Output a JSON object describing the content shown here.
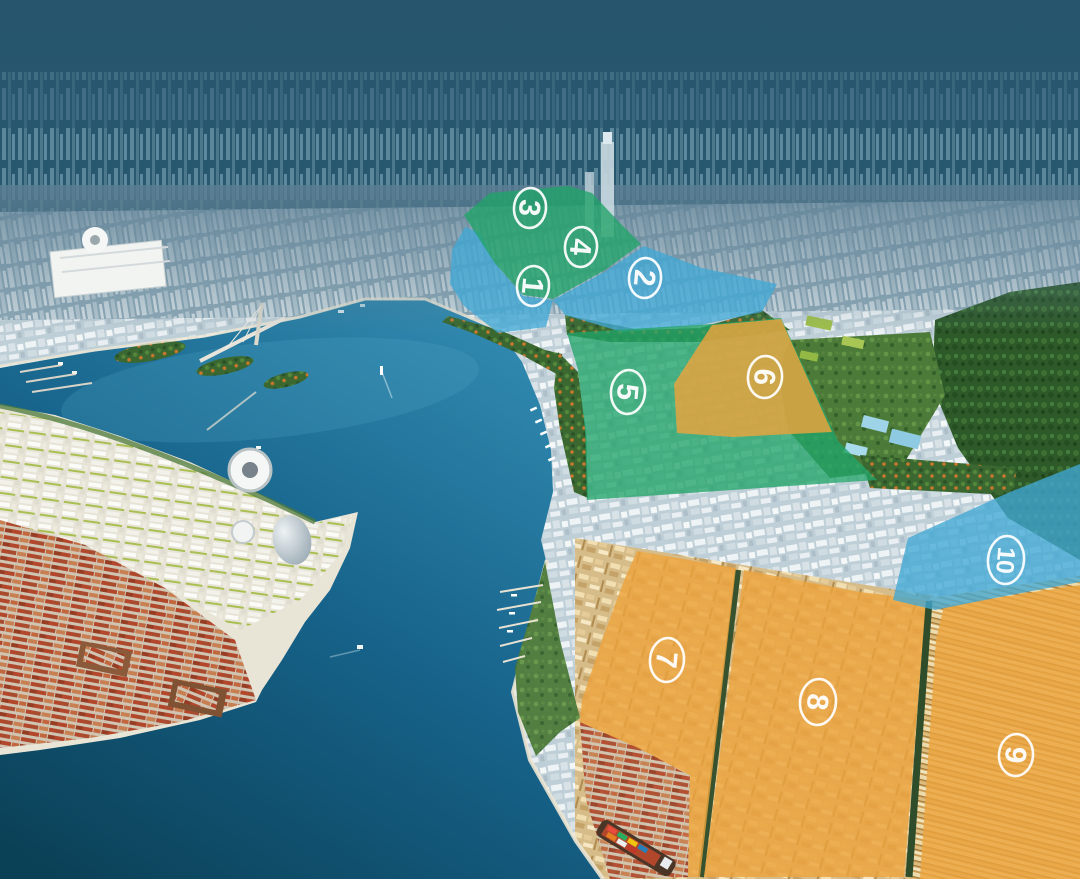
{
  "map": {
    "description": "Aerial masterplan rendering of a coastal bay city with ten numbered planning zones overlaid in color",
    "colors": {
      "sky": "#27566e",
      "haze_city": "#6e96a9",
      "water_light": "#2f87ad",
      "water_deep": "#0b4157",
      "zone_green": "#21a469",
      "zone_blue": "#41a8d5",
      "zone_orange": "#eca33d",
      "badge": "#ffffff",
      "container_red": "#b2472c",
      "forest": "#2e5a2a"
    },
    "zones": [
      {
        "label": "1",
        "color": "blue"
      },
      {
        "label": "2",
        "color": "blue"
      },
      {
        "label": "3",
        "color": "green"
      },
      {
        "label": "4",
        "color": "green"
      },
      {
        "label": "5",
        "color": "green"
      },
      {
        "label": "6",
        "color": "orange"
      },
      {
        "label": "7",
        "color": "orange"
      },
      {
        "label": "8",
        "color": "orange"
      },
      {
        "label": "9",
        "color": "orange"
      },
      {
        "label": "10",
        "color": "blue"
      }
    ]
  }
}
